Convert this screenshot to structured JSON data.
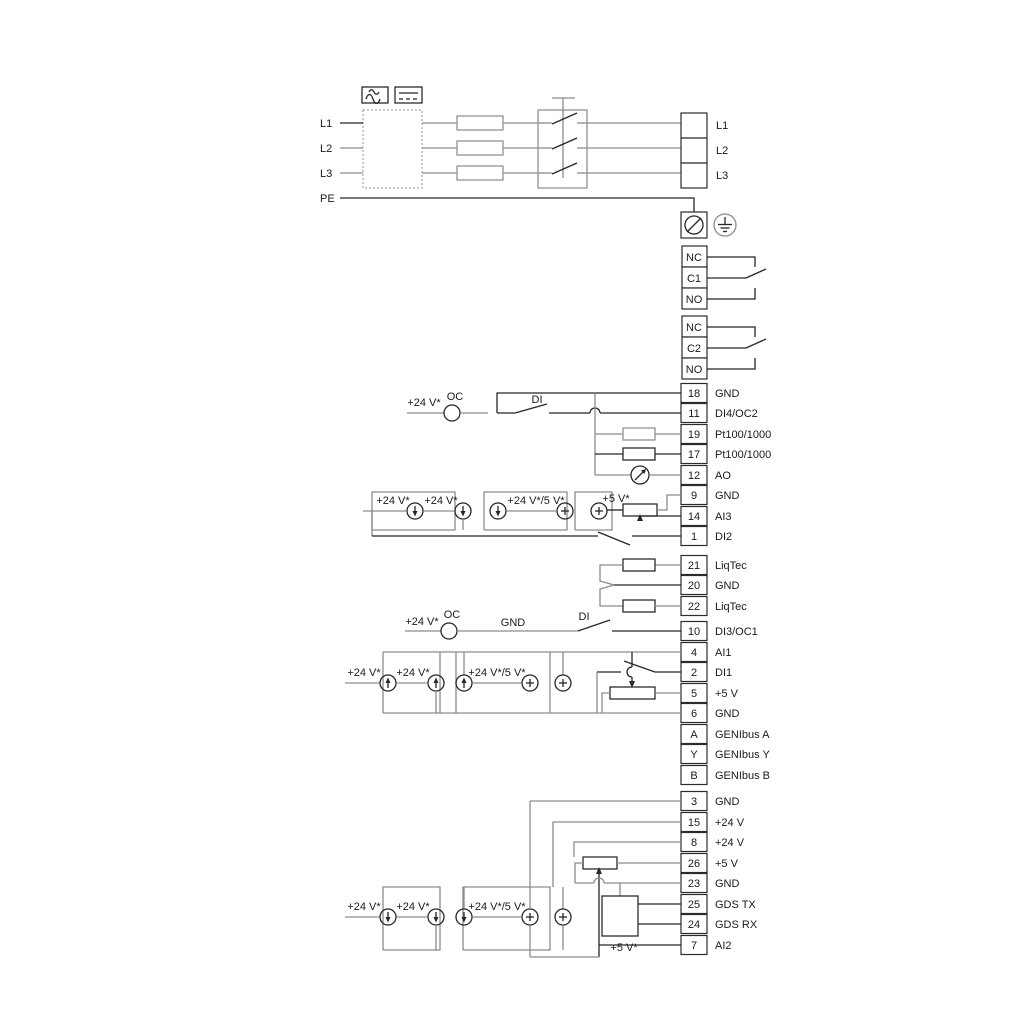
{
  "colors": {
    "wire_gray": "#8c8c8c",
    "wire_dark": "#262626"
  },
  "power": {
    "left_labels": [
      "L1",
      "L2",
      "L3",
      "PE"
    ],
    "right_labels": [
      "L1",
      "L2",
      "L3"
    ]
  },
  "relays": [
    {
      "terminals": [
        "NC",
        "C1",
        "NO"
      ]
    },
    {
      "terminals": [
        "NC",
        "C2",
        "NO"
      ]
    }
  ],
  "terminals": [
    {
      "num": "18",
      "label": "GND"
    },
    {
      "num": "11",
      "label": "DI4/OC2"
    },
    {
      "num": "19",
      "label": "Pt100/1000"
    },
    {
      "num": "17",
      "label": "Pt100/1000"
    },
    {
      "num": "12",
      "label": "AO"
    },
    {
      "num": "9",
      "label": "GND"
    },
    {
      "num": "14",
      "label": "AI3"
    },
    {
      "num": "1",
      "label": "DI2"
    },
    {
      "num": "21",
      "label": "LiqTec"
    },
    {
      "num": "20",
      "label": "GND"
    },
    {
      "num": "22",
      "label": "LiqTec"
    },
    {
      "num": "10",
      "label": "DI3/OC1"
    },
    {
      "num": "4",
      "label": "AI1"
    },
    {
      "num": "2",
      "label": "DI1"
    },
    {
      "num": "5",
      "label": "+5 V"
    },
    {
      "num": "6",
      "label": "GND"
    },
    {
      "num": "A",
      "label": "GENIbus A"
    },
    {
      "num": "Y",
      "label": "GENIbus Y"
    },
    {
      "num": "B",
      "label": "GENIbus B"
    },
    {
      "num": "3",
      "label": "GND"
    },
    {
      "num": "15",
      "label": "+24 V"
    },
    {
      "num": "8",
      "label": "+24 V"
    },
    {
      "num": "26",
      "label": "+5 V"
    },
    {
      "num": "23",
      "label": "GND"
    },
    {
      "num": "25",
      "label": "GDS TX"
    },
    {
      "num": "24",
      "label": "GDS RX"
    },
    {
      "num": "7",
      "label": "AI2"
    }
  ],
  "annotations": [
    {
      "text": "+24 V*"
    },
    {
      "text": "OC"
    },
    {
      "text": "DI"
    },
    {
      "text": "+24 V*"
    },
    {
      "text": "+24 V*"
    },
    {
      "text": "+24 V*/5 V*"
    },
    {
      "text": "+5 V*"
    },
    {
      "text": "+24 V*"
    },
    {
      "text": "OC"
    },
    {
      "text": "GND"
    },
    {
      "text": "DI"
    },
    {
      "text": "+24 V*"
    },
    {
      "text": "+24 V*"
    },
    {
      "text": "+24 V*/5 V*"
    },
    {
      "text": "+24 V*"
    },
    {
      "text": "+24 V*"
    },
    {
      "text": "+24 V*/5 V*"
    },
    {
      "text": "+5 V*"
    }
  ]
}
